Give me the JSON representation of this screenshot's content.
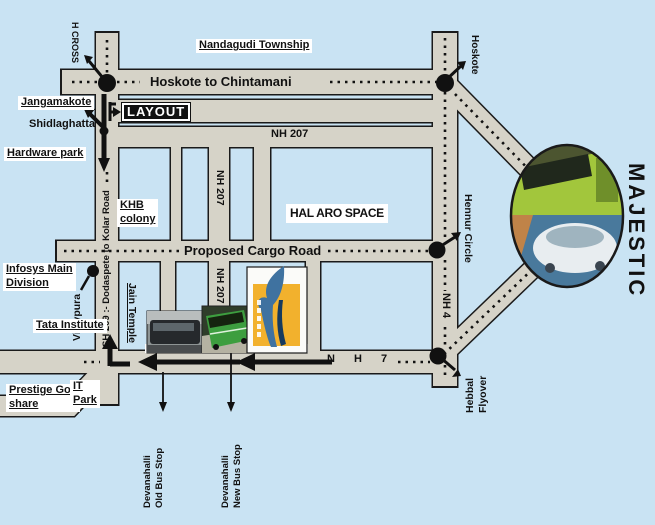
{
  "title": "Layout location route map",
  "colors": {
    "background": "#c9e3f3",
    "road": "#d6d3c8",
    "outline": "#111111",
    "sign_yellow": "#f2b12d",
    "sign_blue": "#3f72a0",
    "bus_green": "#9ac43a"
  },
  "labels": {
    "h_cross": "H CROSS",
    "nandagudi_township": "Nandagudi Township",
    "hoskote_to_chintamani": "Hoskote to Chintamani",
    "hoskote": "Hoskote",
    "jangamakote": "Jangamakote",
    "layout": "LAYOUT",
    "shidlaghatta": "Shidlaghatta",
    "nh_207_highway": "NH 207",
    "nh_207_vertical_upper": "NH 207",
    "nh_207_vertical_lower": "NH 207",
    "hardware_park": "Hardware park",
    "khb_colony": [
      "KHB",
      "colony"
    ],
    "hal_aro_space": "HAL ARO SPACE",
    "sh_209_road": "SH 209 :- Dodaspete to Kolar Road",
    "proposed_cargo_road": "Proposed Cargo Road",
    "hennur_circle": "Hennur Circle",
    "infosys": [
      "Infosys Main",
      "Division"
    ],
    "vijaypura": "Vijaypura",
    "tata_institute": "Tata Institute",
    "jain_temple": "Jain Temple",
    "nh_4": "NH 4",
    "majestic": "MAJESTIC",
    "prestige_golf": [
      "Prestige Golf",
      "share"
    ],
    "it_park": [
      "IT",
      "Park"
    ],
    "nh_7": "N H 7",
    "hebbal_flyover": [
      "Hebbal",
      "Flyover"
    ],
    "devanahalli_old": [
      "Devanahalli",
      "Old Bus Stop"
    ],
    "devanahalli_new": [
      "Devanahalli",
      "New Bus Stop"
    ]
  }
}
